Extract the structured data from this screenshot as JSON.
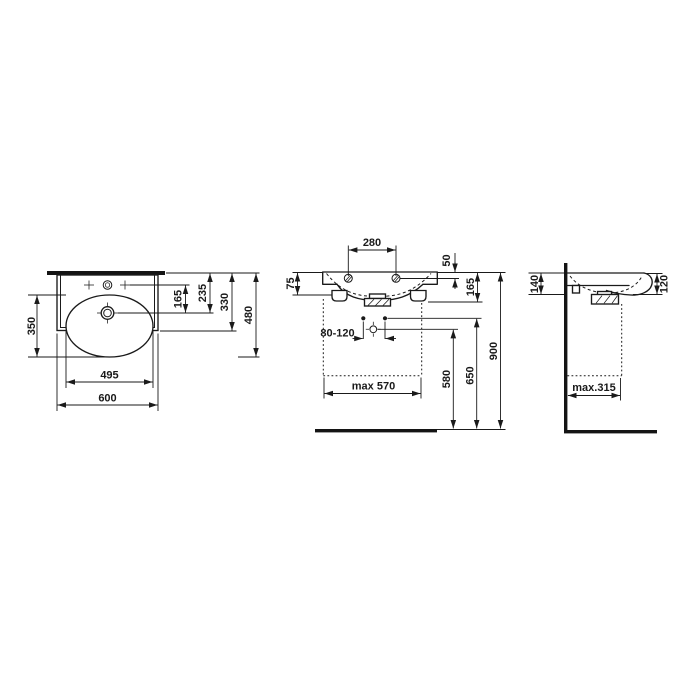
{
  "drawing": {
    "type": "washbasin-installation-dimension-drawing",
    "background": "#ffffff",
    "line_color": "#1a1a1a",
    "views": {
      "top": {
        "label": "top-view",
        "dims": {
          "bowl_depth": "350",
          "tap_to_drain": "165",
          "wall_to_drain": "235",
          "deck_depth": "330",
          "overall_depth": "480",
          "bowl_width": "495",
          "overall_width": "600"
        }
      },
      "front": {
        "label": "front-view",
        "dims": {
          "tap_centres": "280",
          "hole_offset": "50",
          "side_profile": "75",
          "rim_to_outlet": "165",
          "fixing_spacing": "80-120",
          "clearance_width": "max 570",
          "outlet_height": "580",
          "fixing_height": "650",
          "rim_height": "900"
        }
      },
      "side": {
        "label": "side-view",
        "dims": {
          "wall_depth": "140",
          "front_depth": "120",
          "clearance_depth": "max.315"
        }
      }
    }
  }
}
